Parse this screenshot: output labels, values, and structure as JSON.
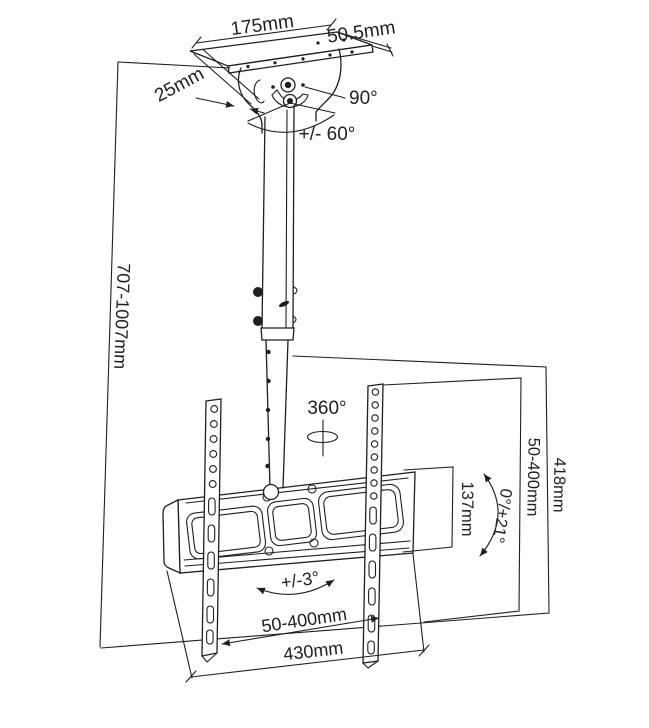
{
  "diagram": {
    "name": "ceiling-tv-mount-dimension-diagram",
    "background_color": "#ffffff",
    "line_color": "#1f1f1f",
    "labels": {
      "plate_width": "175mm",
      "plate_depth": "50.5mm",
      "flange_width": "25mm",
      "joint_angle": "90°",
      "tilt_range_top": "+/- 60°",
      "pole_height_range": "707-1007mm",
      "rotation_range": "360°",
      "vesa_height_range": "50-400mm",
      "bracket_total_height": "418mm",
      "plate_height": "137mm",
      "screen_tilt_range": "0°/+21°",
      "level_adjust_range": "+/-3°",
      "vesa_width_range": "50-400mm",
      "bracket_total_width": "430mm"
    }
  }
}
